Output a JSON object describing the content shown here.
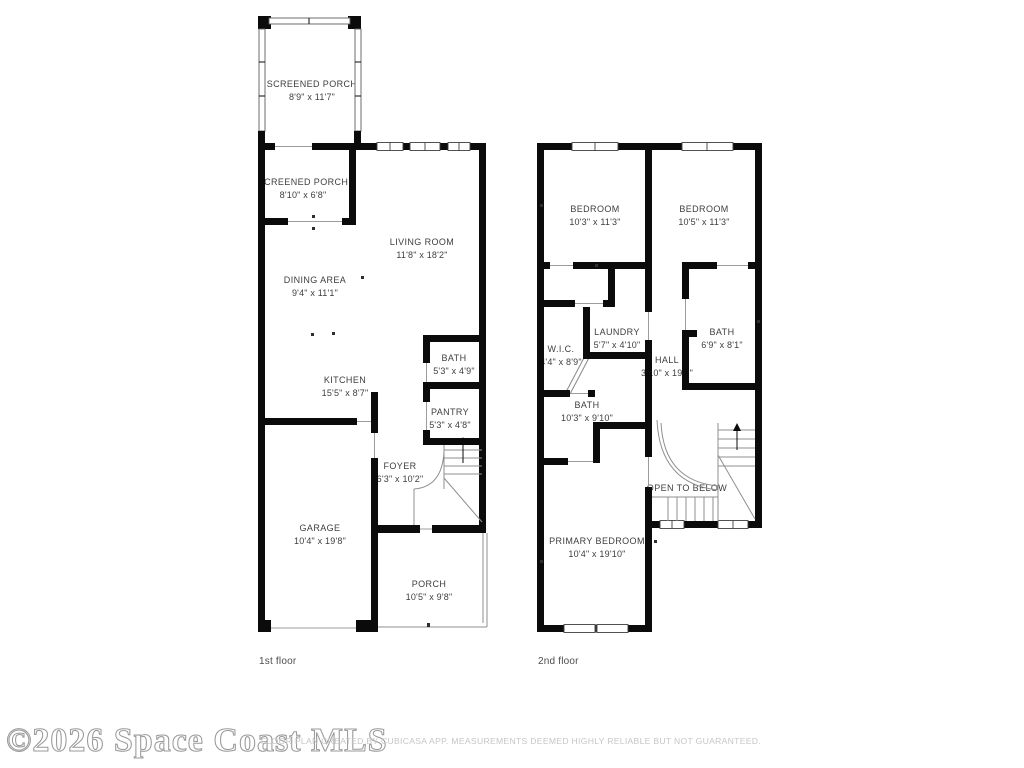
{
  "watermark": "©2026 Space Coast MLS",
  "disclaimer": "FLOOR PLAN CREATED BY CUBICASA APP. MEASUREMENTS DEEMED HIGHLY RELIABLE BUT NOT GUARANTEED.",
  "colors": {
    "wall": "#0b0b0b",
    "label_text": "#3e3e3e",
    "thin_line": "#9c9c9c",
    "muted_text": "#c6c6c6"
  },
  "floors": {
    "first": {
      "label": "1st floor",
      "rooms": {
        "screened_porch_upper": {
          "name": "SCREENED PORCH",
          "dims": "8'9\" x 11'7\""
        },
        "screened_porch_lower": {
          "name": "SCREENED PORCH",
          "dims": "8'10\" x 6'8\""
        },
        "living_room": {
          "name": "LIVING ROOM",
          "dims": "11'8\" x 18'2\""
        },
        "dining_area": {
          "name": "DINING AREA",
          "dims": "9'4\" x 11'1\""
        },
        "kitchen": {
          "name": "KITCHEN",
          "dims": "15'5\" x 8'7\""
        },
        "bath": {
          "name": "BATH",
          "dims": "5'3\" x 4'9\""
        },
        "pantry": {
          "name": "PANTRY",
          "dims": "5'3\" x 4'8\""
        },
        "foyer": {
          "name": "FOYER",
          "dims": "6'3\" x 10'2\""
        },
        "garage": {
          "name": "GARAGE",
          "dims": "10'4\" x 19'8\""
        },
        "porch": {
          "name": "PORCH",
          "dims": "10'5\" x 9'8\""
        }
      }
    },
    "second": {
      "label": "2nd floor",
      "rooms": {
        "bedroom_left": {
          "name": "BEDROOM",
          "dims": "10'3\" x 11'3\""
        },
        "bedroom_right": {
          "name": "BEDROOM",
          "dims": "10'5\" x 11'3\""
        },
        "laundry": {
          "name": "LAUNDRY",
          "dims": "5'7\" x 4'10\""
        },
        "wic": {
          "name": "W.I.C.",
          "dims": "4'4\" x 8'9\""
        },
        "bath_upper": {
          "name": "BATH",
          "dims": "6'9\" x 8'1\""
        },
        "hall": {
          "name": "HALL",
          "dims": "3'10\" x 19'3\""
        },
        "bath_lower": {
          "name": "BATH",
          "dims": "10'3\" x 9'10\""
        },
        "open_to_below": {
          "name": "OPEN TO BELOW"
        },
        "primary_bedroom": {
          "name": "PRIMARY BEDROOM",
          "dims": "10'4\" x 19'10\""
        }
      }
    }
  }
}
